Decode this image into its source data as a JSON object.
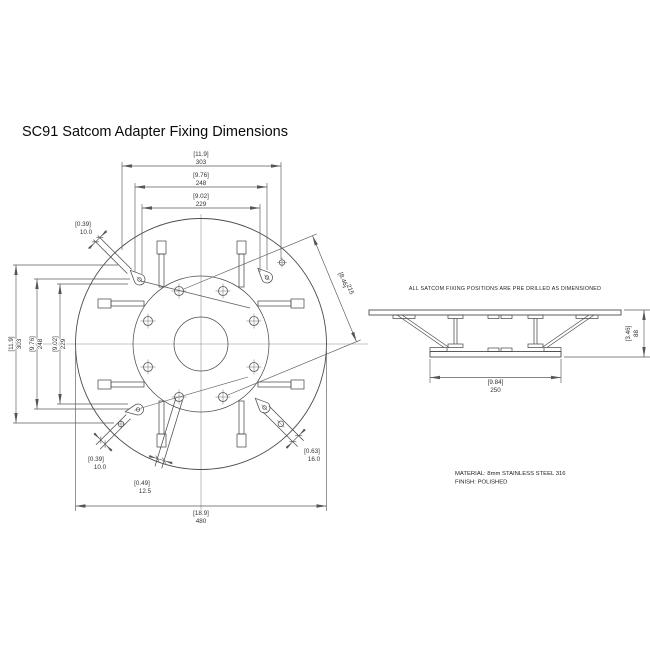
{
  "title": "SC91 Satcom Adapter Fixing Dimensions",
  "note": "ALL SATCOM FIXING POSITIONS ARE PRE DRILLED AS DIMENSIONED",
  "material": {
    "line1": "MATERIAL: 8mm STAINLESS STEEL 316",
    "line2": "FINISH: POLISHED"
  },
  "dims": {
    "overall_dia": {
      "inch": "[18.9]",
      "mm": "480"
    },
    "pattern_303": {
      "inch": "[11.9]",
      "mm": "303"
    },
    "pattern_248": {
      "inch": "[9.76]",
      "mm": "248"
    },
    "pattern_229": {
      "inch": "[9.02]",
      "mm": "229"
    },
    "bolt_circle": {
      "inch": "[8.46]",
      "mm": "215"
    },
    "hole_10": {
      "inch": "[0.39]",
      "mm": "10.0"
    },
    "slot_12_5": {
      "inch": "[0.49]",
      "mm": "12.5"
    },
    "slot_16": {
      "inch": "[0.63]",
      "mm": "16.0"
    },
    "base_width": {
      "inch": "[9.84]",
      "mm": "250"
    },
    "height": {
      "inch": "[3.46]",
      "mm": "88"
    }
  }
}
